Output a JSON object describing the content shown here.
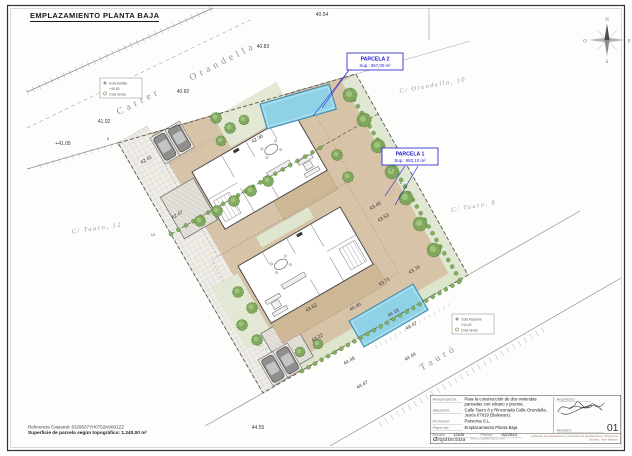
{
  "page": {
    "title": "EMPLAZAMIENTO PLANTA BAJA"
  },
  "compass": {
    "n": "N",
    "e": "E",
    "s": "S",
    "w": "O"
  },
  "parcels": [
    {
      "name": "PARCELA 2",
      "sup": "Sup.: 657,00 m²"
    },
    {
      "name": "PARCELA 1",
      "sup": "Sup.: 683,10 m²"
    }
  ],
  "street_labels": [
    {
      "t": "Carrer",
      "x": 140,
      "y": 104,
      "r": -27,
      "cls": "street-big"
    },
    {
      "t": "Orandella",
      "x": 224,
      "y": 64,
      "r": -27,
      "cls": "street-big"
    },
    {
      "t": "C/ Orendella, 10",
      "x": 433,
      "y": 87,
      "r": -10,
      "cls": "street-small"
    },
    {
      "t": "C/ Tauro, 8",
      "x": 474,
      "y": 208,
      "r": -10,
      "cls": "street-small"
    },
    {
      "t": "C/ Tauro, 12",
      "x": 97,
      "y": 230,
      "r": -8,
      "cls": "street-small"
    },
    {
      "t": "Tauró",
      "x": 440,
      "y": 360,
      "r": -31,
      "cls": "street-big"
    },
    {
      "t": "Carrer",
      "x": 455,
      "y": 418,
      "r": -31,
      "cls": "street-big"
    }
  ],
  "elevations": [
    {
      "t": "40.54",
      "x": 322,
      "y": 16,
      "r": 0
    },
    {
      "t": "40.83",
      "x": 263,
      "y": 48,
      "r": 0
    },
    {
      "t": "40.82",
      "x": 183,
      "y": 93,
      "r": 0
    },
    {
      "t": "41.02",
      "x": 104,
      "y": 123,
      "r": 0
    },
    {
      "t": "+41.05",
      "x": 63,
      "y": 145,
      "r": 0
    },
    {
      "t": "42.41",
      "x": 147,
      "y": 161,
      "r": -30
    },
    {
      "t": "42.47",
      "x": 178,
      "y": 216,
      "r": -30
    },
    {
      "t": "42.36",
      "x": 258,
      "y": 140,
      "r": -30
    },
    {
      "t": "43.46",
      "x": 376,
      "y": 207,
      "r": -30
    },
    {
      "t": "43.53",
      "x": 384,
      "y": 219,
      "r": -30
    },
    {
      "t": "43.76",
      "x": 415,
      "y": 271,
      "r": -30
    },
    {
      "t": "43.71",
      "x": 385,
      "y": 283,
      "r": -30
    },
    {
      "t": "43.62",
      "x": 312,
      "y": 309,
      "r": -30
    },
    {
      "t": "43.22",
      "x": 318,
      "y": 339,
      "r": -30
    },
    {
      "t": "44.46",
      "x": 356,
      "y": 308,
      "r": -30
    },
    {
      "t": "44.16",
      "x": 394,
      "y": 314,
      "r": -30
    },
    {
      "t": "44.47",
      "x": 412,
      "y": 327,
      "r": -30
    },
    {
      "t": "44.44",
      "x": 411,
      "y": 358,
      "r": -30
    },
    {
      "t": "44.46",
      "x": 350,
      "y": 362,
      "r": -30
    },
    {
      "t": "44.47",
      "x": 363,
      "y": 386,
      "r": -30
    },
    {
      "t": "44.55",
      "x": 258,
      "y": 429,
      "r": 0
    }
  ],
  "point_markers": [
    {
      "t": "8",
      "x": 108,
      "y": 140
    },
    {
      "t": "10",
      "x": 153,
      "y": 236
    },
    {
      "t": "1",
      "x": 391,
      "y": 171
    },
    {
      "t": "2",
      "x": 401,
      "y": 184
    }
  ],
  "legends": [
    {
      "l1": "Cota Asfalto",
      "l2": "+40,50",
      "l3": "Cota Verde"
    },
    {
      "l1": "Cota Rasante",
      "l2": "+44,40",
      "l3": "Cota Verde"
    }
  ],
  "notes": {
    "line1": "Referencia Catastral: 6329507YH0752N0001ZZ",
    "line2": "Superficie de parcela según topográfico: 1.240,00 m²"
  },
  "tb": {
    "r1l": "Anteproyecto:",
    "r1v1": "Para la construcción de dos viviendas",
    "r1v2": "pareadas con sótano y piscina.",
    "r2l": "Situación:",
    "r2v1": "Calle Tauro 8 y Rinconada Calle Orendella,",
    "r2v2": "Jesús 07819 (Baleares).",
    "r3l": "Promotor:",
    "r3v": "Parserva S.L.",
    "r4l": "Plano de:",
    "r4v": "Emplazamiento Planta Baja",
    "escala_l": "Escala:",
    "escala_v": "1/100",
    "fecha_l": "Fecha:",
    "fecha_v": "02/2023",
    "arq_l": "Arquitecto:",
    "num_l": "Número:",
    "num_v": "01",
    "logo_a": "a",
    "logo_rest": "rquitectura",
    "web": "www.arquitectura.com",
    "small1": "gabinete de arquitectura y proyectos de arquitectura y urbanismo",
    "small2": "Eivissa · Illes Balears"
  },
  "colors": {
    "accent_blue": "#1a1acc",
    "pool": "#8fd2e8",
    "terrace": "#d7c3a8",
    "vegetation": "#7fa85f",
    "paper": "#fdfdfb"
  }
}
